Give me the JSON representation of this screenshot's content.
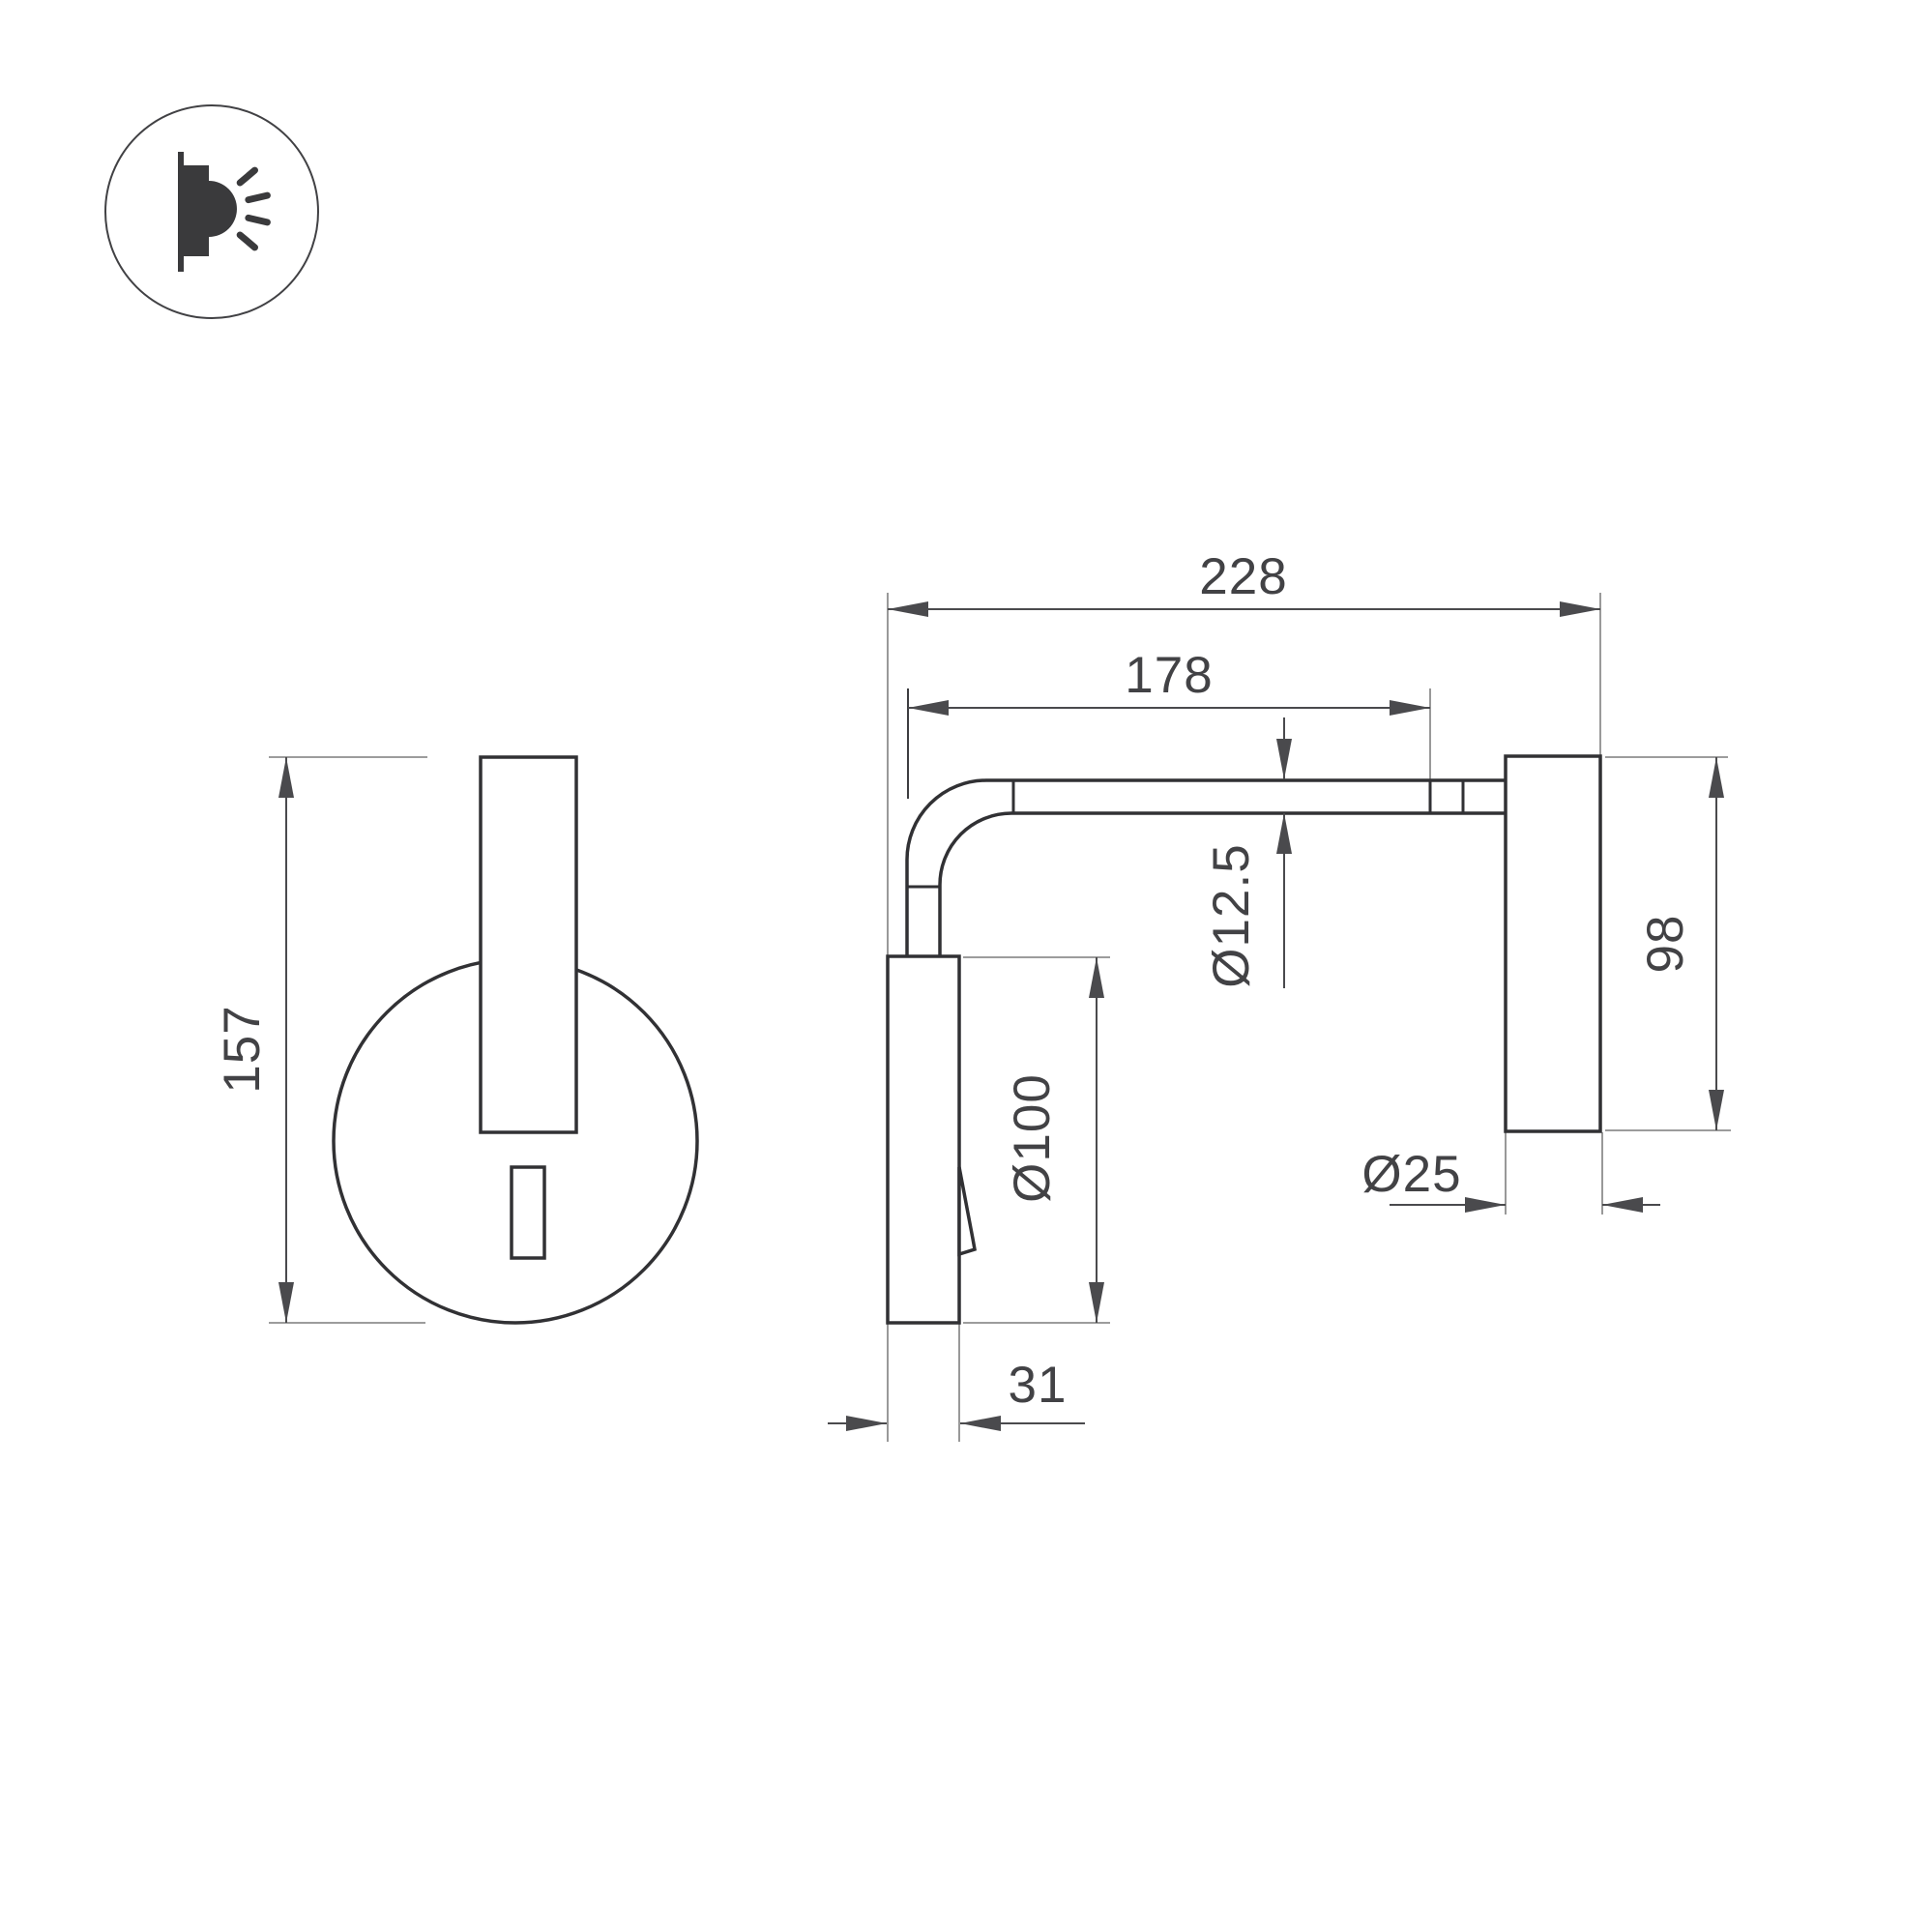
{
  "title": "Wall reading lamp technical drawing",
  "icon": {
    "name": "wall-light-icon"
  },
  "dims": {
    "d157": "157",
    "d228": "228",
    "d178": "178",
    "d12_5": "Ø12.5",
    "d100": "Ø100",
    "d98": "98",
    "d25": "Ø25",
    "d31": "31"
  },
  "colors": {
    "line": "#313134",
    "dimension": "#4a4a4d",
    "extension": "#8e8e8e",
    "text": "#424245",
    "background": "#ffffff"
  }
}
